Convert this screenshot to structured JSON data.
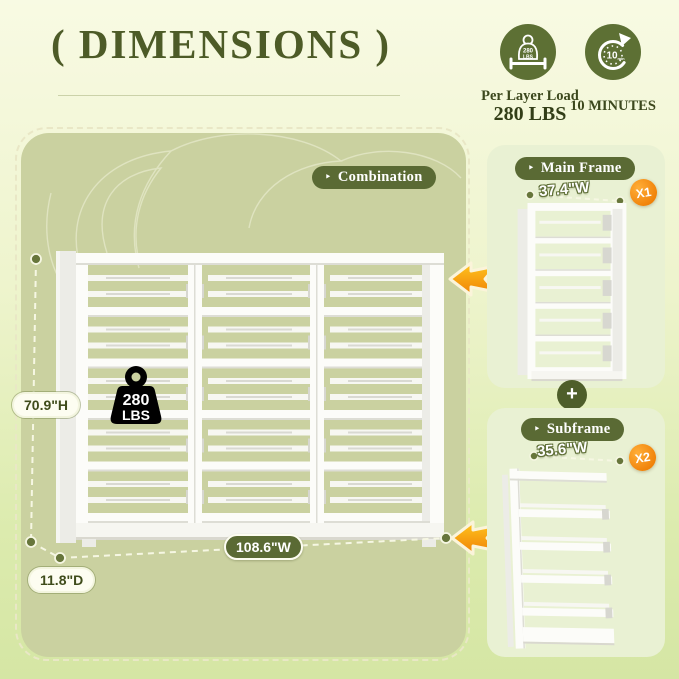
{
  "title": "( DIMENSIONS )",
  "features": {
    "load": {
      "icon": "weight-icon",
      "icon_text_top": "280",
      "icon_text_bottom": "LBS",
      "caption_line1": "Per Layer Load",
      "caption_line2": "280 LBS"
    },
    "assembly": {
      "icon": "timer-icon",
      "icon_text": "10",
      "icon_subtext": "min",
      "caption": "10 MINUTES"
    }
  },
  "combination": {
    "tag_label": "Combination",
    "height_label": "70.9\"H",
    "width_label": "108.6\"W",
    "depth_label": "11.8\"D",
    "weight_line1": "280",
    "weight_line2": "LBS"
  },
  "main_frame": {
    "title": "Main Frame",
    "width_label": "37.4\"W",
    "quantity": "X1"
  },
  "subframe": {
    "title": "Subframe",
    "width_label": "35.6\"W",
    "quantity": "X2"
  },
  "plus_sign": "+",
  "icons": {
    "tag_arrow": "‣"
  },
  "colors": {
    "dark_green": "#4d5b27",
    "pill_green": "#5a6a34",
    "icon_circle_green": "#5d7034",
    "badge_orange": "#f08108",
    "arrow_orange": "#f9a50e",
    "panel_olive": "#cad1a0",
    "panel_light": "#e9f1d3"
  }
}
